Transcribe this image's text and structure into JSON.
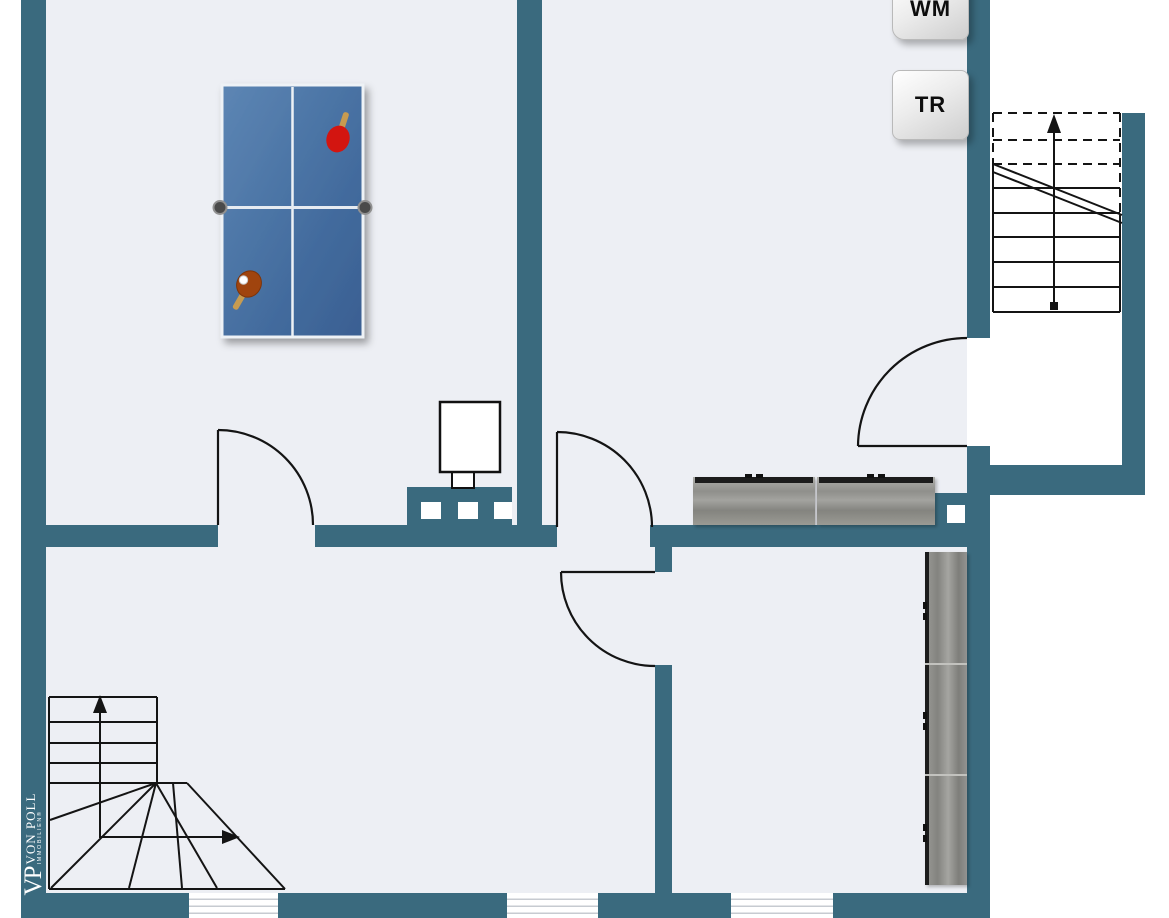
{
  "brand": {
    "monogram": "VP",
    "name": "VON POLL",
    "subtitle": "IMMOBILIEN®"
  },
  "appliances": [
    {
      "label": "WM"
    },
    {
      "label": "TR"
    }
  ],
  "plan": {
    "type": "floor-plan",
    "colors": {
      "wall": "#3a6a7e",
      "floor": "#edeff4",
      "outside": "#ffffff",
      "linework": "#141414",
      "table_blue": "#46709f",
      "paddle_red": "#d31510",
      "paddle_brown": "#a0440e",
      "furniture_gray": "#93938f"
    },
    "symbols": [
      "ping-pong-table",
      "table-tennis-paddle-red",
      "table-tennis-paddle-brown",
      "ball",
      "boiler-on-knee-wall",
      "sideboard-two-segments",
      "tall-wardrobe-three-segments",
      "washing-machine-box",
      "dryer-box",
      "staircase-upper-right-with-cut-line",
      "winder-staircase-lower-left",
      "door-arc-top-left-room",
      "door-arc-center",
      "door-arc-lower-right-room",
      "door-arc-utility-room",
      "window-bottom-left",
      "window-bottom-middle",
      "window-bottom-right"
    ]
  }
}
